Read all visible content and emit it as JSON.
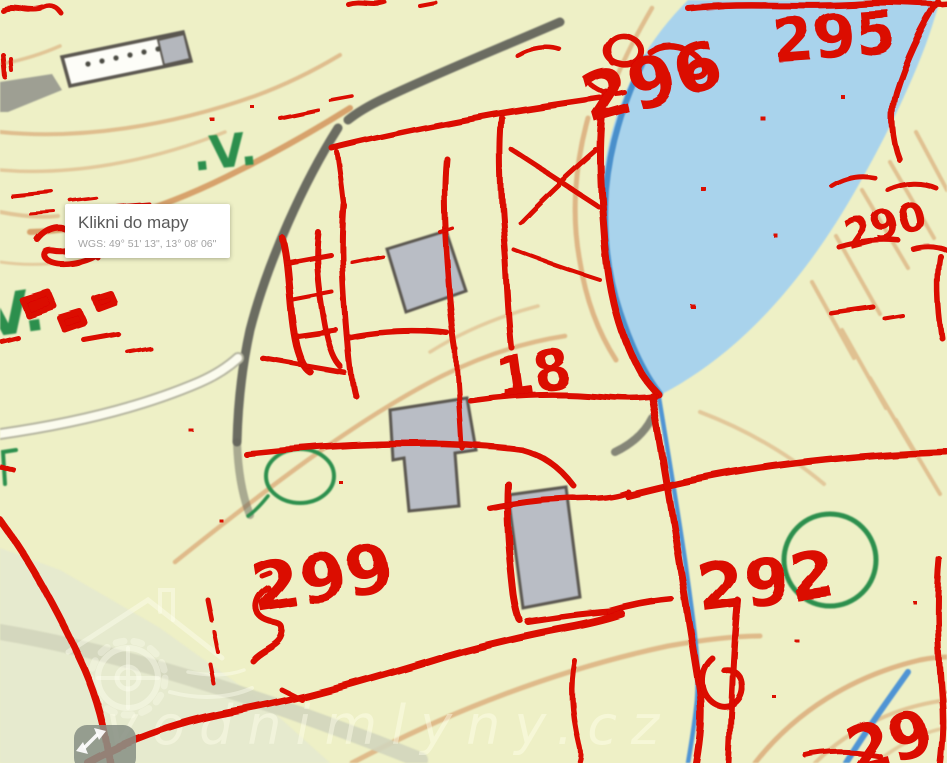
{
  "tooltip": {
    "title": "Klikni do mapy",
    "coords": "WGS: 49° 51' 13\", 13° 08' 06\""
  },
  "watermark": {
    "text": "vodnimlyny.cz"
  },
  "overlay": {
    "color": "#db0701",
    "parcel_labels": [
      {
        "text": "296"
      },
      {
        "text": "295"
      },
      {
        "text": "290"
      },
      {
        "text": "18"
      },
      {
        "text": "299"
      },
      {
        "text": "292"
      },
      {
        "text": "29"
      }
    ]
  },
  "base_map": {
    "vegetation_symbols": [
      {
        "text": ".V."
      },
      {
        "text": "V."
      }
    ],
    "colors": {
      "land": "#eef0c6",
      "water": "#a9d3ec",
      "water_edge": "#3e87c8",
      "contour": "#d9a876",
      "road_dark": "#63645c",
      "building_fill": "#b9bdc5",
      "cadastre_red": "#db0701",
      "vegetation_green": "#2c8f4d"
    }
  },
  "icons": {
    "move_control": "diagonal-move-arrows",
    "watermark_logo": "watermill-wheel"
  }
}
